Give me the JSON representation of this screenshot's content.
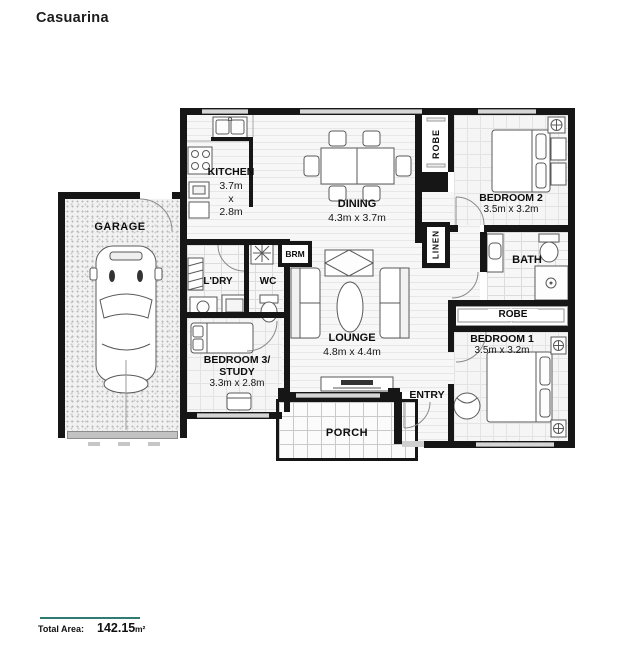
{
  "title": "Casuarina",
  "rooms": {
    "garage": {
      "name": "GARAGE"
    },
    "kitchen": {
      "name": "KITCHEN",
      "dims": "3.7m\nx\n2.8m"
    },
    "dining": {
      "name": "DINING",
      "dims": "4.3m x 3.7m"
    },
    "robe2": {
      "name": "ROBE"
    },
    "bedroom2": {
      "name": "BEDROOM 2",
      "dims": "3.5m x 3.2m"
    },
    "linen": {
      "name": "LINEN"
    },
    "bath": {
      "name": "BATH"
    },
    "brm": {
      "name": "BRM"
    },
    "laundry": {
      "name": "L'DRY"
    },
    "wc": {
      "name": "WC"
    },
    "lounge": {
      "name": "LOUNGE",
      "dims": "4.8m x 4.4m"
    },
    "robe1": {
      "name": "ROBE"
    },
    "bedroom1": {
      "name": "BEDROOM 1",
      "dims": "3.5m x 3.2m"
    },
    "bedroom3": {
      "name": "BEDROOM 3/\nSTUDY",
      "dims": "3.3m x 2.8m"
    },
    "entry": {
      "name": "ENTRY"
    },
    "porch": {
      "name": "PORCH"
    }
  },
  "footer": {
    "label": "Total Area:",
    "value": "142.15",
    "unit": "m²"
  },
  "colors": {
    "wall": "#161616",
    "accent_rule": "#2e7b72",
    "window": "#d6d6d6"
  }
}
